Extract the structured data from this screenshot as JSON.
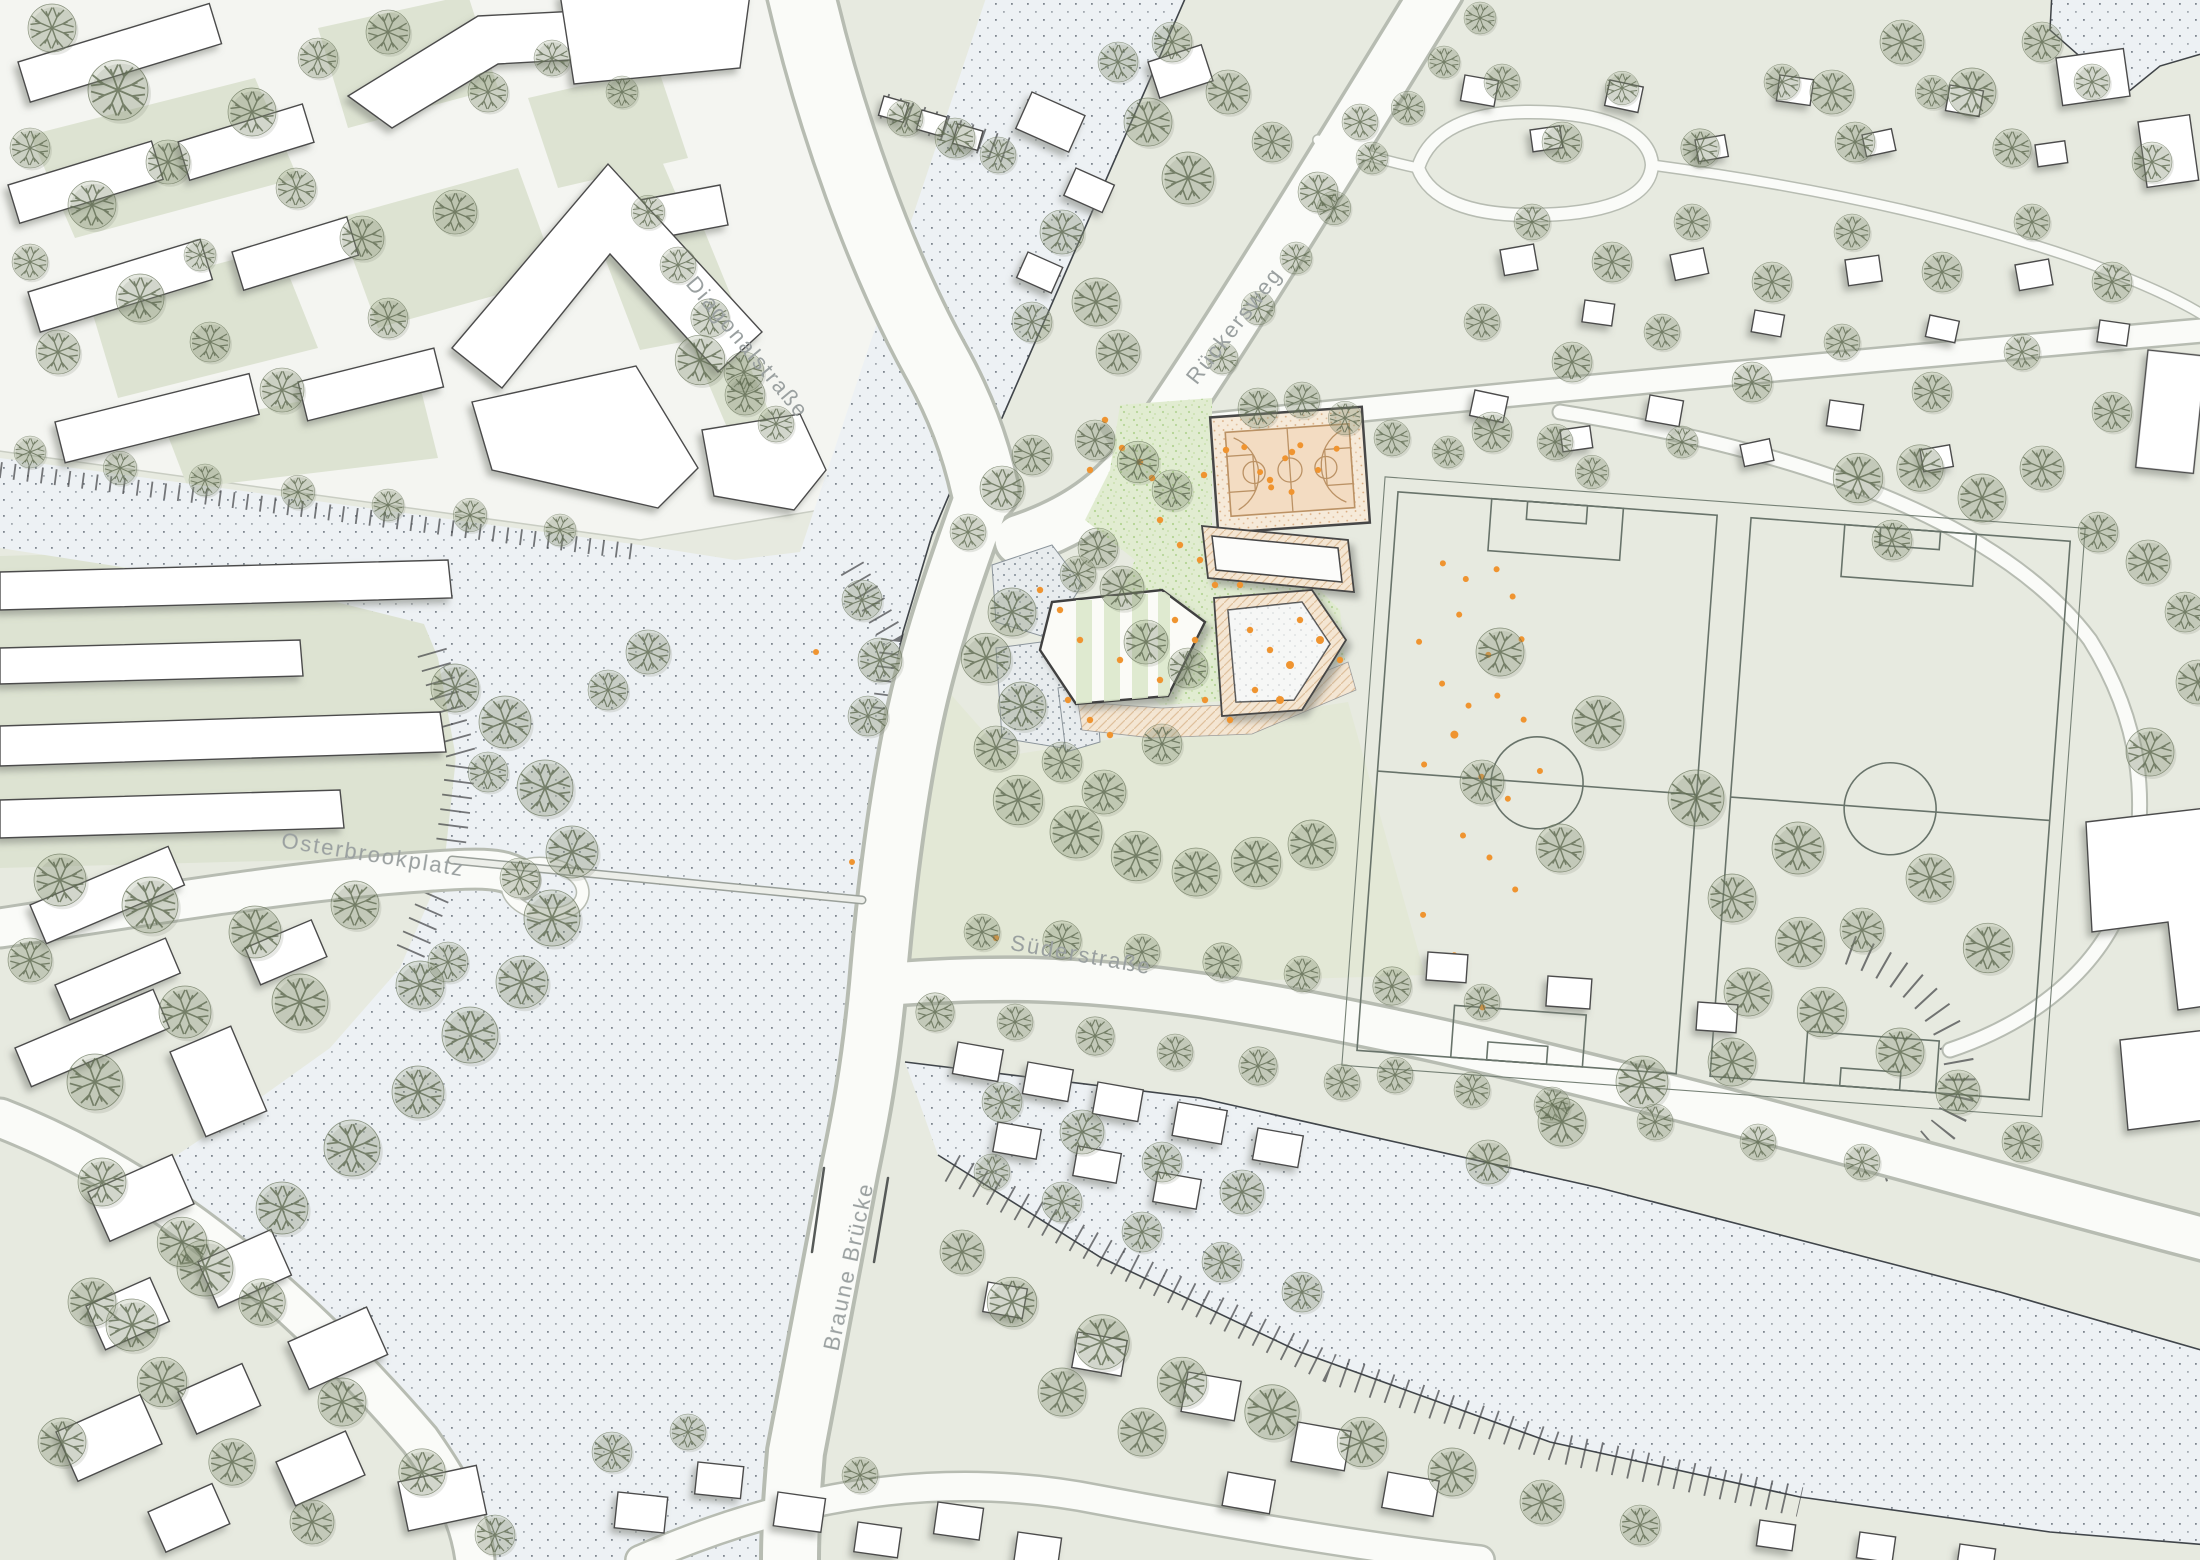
{
  "map": {
    "labels": {
      "diagonal": "Diagonalstraße",
      "rueckersweg": "Rückersweg",
      "osterbrookplatz": "Osterbrookplatz",
      "suederstrasse": "Süderstraße",
      "braune_bruecke": "Braune Brücke"
    },
    "palette": {
      "ground": "#e7eae0",
      "paved_block": "#f4f5f1",
      "courtyard_green": "#dde3d2",
      "water": "#edf1f4",
      "water_dot": "#5a646e",
      "street_fill": "#fafbf8",
      "street_edge": "#b7bcb2",
      "building_fill": "#ffffff",
      "building_outline": "#4c4c4c",
      "tree_green": "#5e6a50",
      "lawn": "#e1ecd1",
      "lawn_speckle": "#b3d493",
      "plaza": "#e8ecee",
      "plaza_dot": "#808b94",
      "path_tan": "#f4e6d3",
      "path_tan_hatch": "#dfc09c",
      "court_fill": "#f3dcc2",
      "court_line": "#bb9265",
      "field_line": "#68736a",
      "people_orange": "#ef9430",
      "label_gray": "#9aa0a0",
      "shore_line": "#3f4347"
    }
  }
}
